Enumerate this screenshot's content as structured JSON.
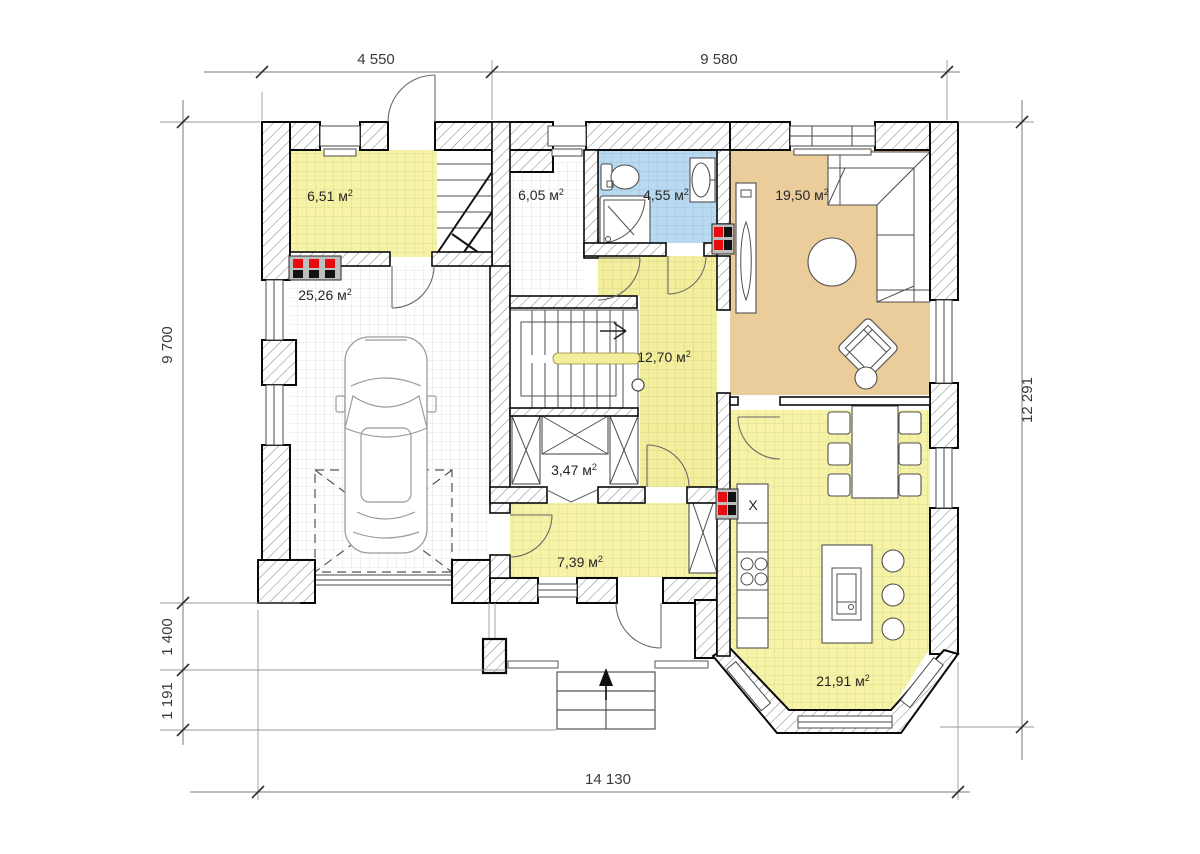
{
  "plan": {
    "rooms": [
      {
        "name": "entry-hall",
        "area": "6,51 м",
        "sup": "2",
        "color": "#F6F3A6"
      },
      {
        "name": "hall",
        "area": "6,05 м",
        "sup": "2",
        "color": "#FFFFFF"
      },
      {
        "name": "bathroom",
        "area": "4,55 м",
        "sup": "2",
        "color": "#B7DAF2"
      },
      {
        "name": "living-room",
        "area": "19,50 м",
        "sup": "2",
        "color": "#EBCD9B"
      },
      {
        "name": "garage",
        "area": "25,26 м",
        "sup": "2",
        "color": "#FFFFFF"
      },
      {
        "name": "stair-hall",
        "area": "12,70 м",
        "sup": "2",
        "color": "#F2EE9B"
      },
      {
        "name": "closet",
        "area": "3,47 м",
        "sup": "2",
        "color": "#FFFFFF"
      },
      {
        "name": "hallway",
        "area": "7,39 м",
        "sup": "2",
        "color": "#F6F3A6"
      },
      {
        "name": "kitchen-dining",
        "area": "21,91 м",
        "sup": "2",
        "color": "#F6F3A6"
      }
    ],
    "dimensions": {
      "top_left": "4 550",
      "top_right": "9 580",
      "left_main": "9 700",
      "left_porch": "1 400",
      "left_steps": "1 191",
      "right": "12 291",
      "bottom": "14 130"
    },
    "appliances": {
      "fridge_label": "X"
    }
  }
}
